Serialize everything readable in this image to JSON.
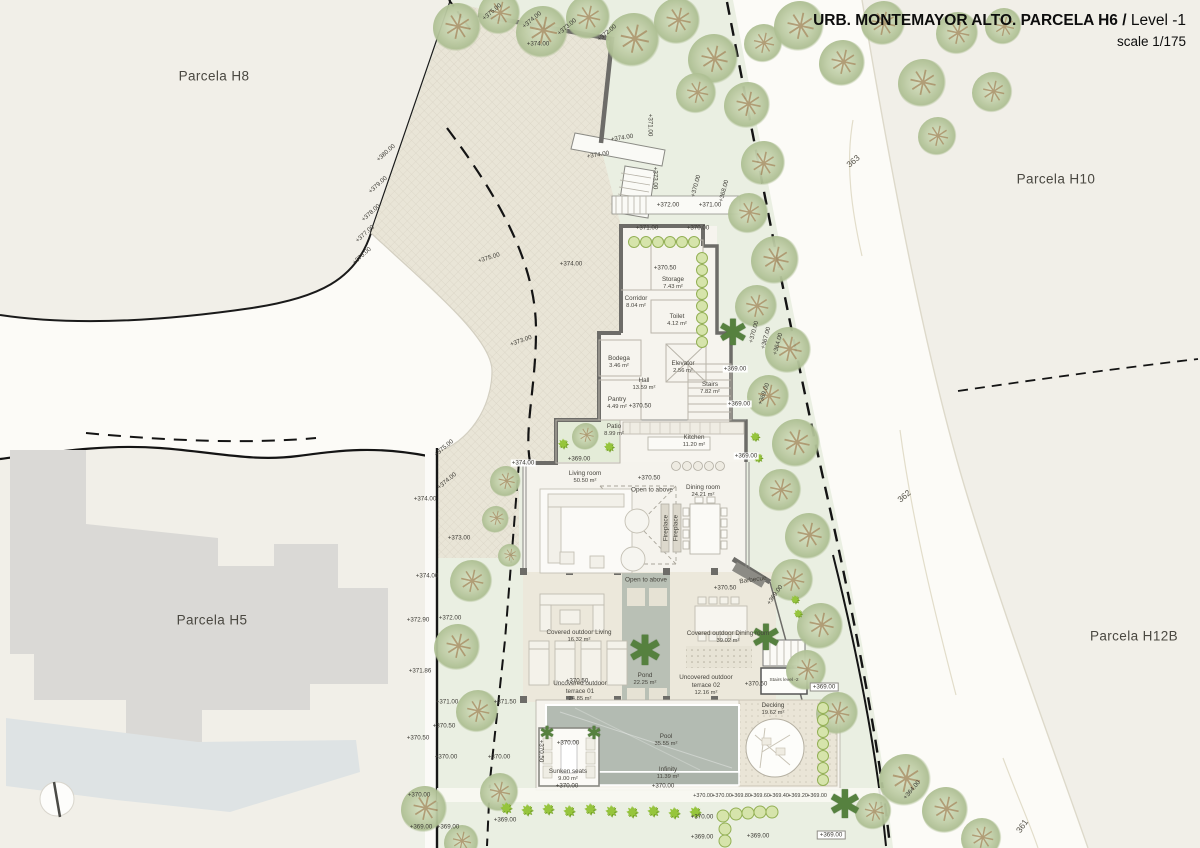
{
  "title": {
    "project": "URB. MONTEMAYOR ALTO. PARCELA H6 /",
    "level": " Level -1",
    "scale": "scale 1/175"
  },
  "parcel_labels": [
    {
      "t": "Parcela H8",
      "x": 214,
      "y": 76
    },
    {
      "t": "Parcela H10",
      "x": 1056,
      "y": 179
    },
    {
      "t": "Parcela H5",
      "x": 212,
      "y": 620
    },
    {
      "t": "Parcela H12B",
      "x": 1134,
      "y": 636
    }
  ],
  "contour_labels": [
    {
      "t": "363",
      "x": 853,
      "y": 161,
      "r": -40
    },
    {
      "t": "362",
      "x": 904,
      "y": 496,
      "r": -40
    },
    {
      "t": "361",
      "x": 1022,
      "y": 826,
      "r": -55
    }
  ],
  "rooms": [
    {
      "name": "Storage",
      "area": "7.43 m²",
      "x": 673,
      "y": 284
    },
    {
      "name": "Corridor",
      "area": "8.04 m²",
      "x": 636,
      "y": 303
    },
    {
      "name": "Toilet",
      "area": "4.12 m²",
      "x": 677,
      "y": 321
    },
    {
      "name": "Bodega",
      "area": "3.46 m²",
      "x": 619,
      "y": 363
    },
    {
      "name": "Elevator",
      "area": "2.56 m²",
      "x": 683,
      "y": 368
    },
    {
      "name": "Hall",
      "area": "13.59 m²",
      "x": 644,
      "y": 385
    },
    {
      "name": "Stairs",
      "area": "7.82 m²",
      "x": 710,
      "y": 389
    },
    {
      "name": "Pantry",
      "area": "4.49 m²",
      "x": 617,
      "y": 404
    },
    {
      "name": "Patio",
      "area": "8.99 m²",
      "x": 614,
      "y": 431
    },
    {
      "name": "Kitchen",
      "area": "11.20 m²",
      "x": 694,
      "y": 442
    },
    {
      "name": "Living room",
      "area": "50.50 m²",
      "x": 585,
      "y": 478
    },
    {
      "name": "Dining room",
      "area": "24.21 m²",
      "x": 703,
      "y": 492
    },
    {
      "name": "Covered outdoor Living",
      "area": "16.32 m²",
      "x": 579,
      "y": 637
    },
    {
      "name": "Covered outdoor Dining room",
      "area": "39.02 m²",
      "x": 728,
      "y": 638
    },
    {
      "name": "Pond",
      "area": "22.25 m²",
      "x": 645,
      "y": 680
    },
    {
      "name": "Uncovered outdoor",
      "name2": "terrace 01",
      "area": "24.85 m²",
      "x": 580,
      "y": 692
    },
    {
      "name": "Uncovered outdoor",
      "name2": "terrace 02",
      "area": "12.16 m²",
      "x": 706,
      "y": 686
    },
    {
      "name": "Stairs level -2",
      "area": "",
      "x": 784,
      "y": 681,
      "c": "sm"
    },
    {
      "name": "Decking",
      "area": "19.62 m²",
      "x": 773,
      "y": 710
    },
    {
      "name": "Pool",
      "area": "35.55 m²",
      "x": 666,
      "y": 741
    },
    {
      "name": "Infinity",
      "area": "11.39 m²",
      "x": 668,
      "y": 774
    },
    {
      "name": "Sunken seats",
      "area": "9.00 m²",
      "x": 568,
      "y": 776
    }
  ],
  "annotations": [
    {
      "t": "Open to above",
      "x": 652,
      "y": 490
    },
    {
      "t": "Open to above",
      "x": 646,
      "y": 580
    },
    {
      "t": "Barbecue",
      "x": 753,
      "y": 580,
      "r": -8
    },
    {
      "t": "Fireplace",
      "x": 666,
      "y": 528,
      "r": -90
    },
    {
      "t": "Fireplace",
      "x": 676,
      "y": 528,
      "r": -90
    }
  ],
  "elevations": [
    {
      "t": "+374.00",
      "x": 538,
      "y": 44
    },
    {
      "t": "+374.00",
      "x": 622,
      "y": 138,
      "r": -9
    },
    {
      "t": "+374.00",
      "x": 598,
      "y": 155,
      "r": -9
    },
    {
      "t": "+375.00",
      "x": 492,
      "y": 12,
      "r": -40
    },
    {
      "t": "+374.00",
      "x": 532,
      "y": 20,
      "r": -40
    },
    {
      "t": "+373.00",
      "x": 567,
      "y": 27,
      "r": -40
    },
    {
      "t": "+372.00",
      "x": 607,
      "y": 33,
      "r": -40
    },
    {
      "t": "+371.00",
      "x": 650,
      "y": 125,
      "r": 90
    },
    {
      "t": "+373.00",
      "x": 655,
      "y": 178,
      "r": 90
    },
    {
      "t": "+372.00",
      "x": 668,
      "y": 205
    },
    {
      "t": "+371.00",
      "x": 710,
      "y": 205
    },
    {
      "t": "+371.00",
      "x": 647,
      "y": 228
    },
    {
      "t": "+370.00",
      "x": 698,
      "y": 228
    },
    {
      "t": "+370.00",
      "x": 696,
      "y": 186,
      "r": -75
    },
    {
      "t": "+368.00",
      "x": 724,
      "y": 191,
      "r": -75
    },
    {
      "t": "+380.00",
      "x": 386,
      "y": 153,
      "r": -42
    },
    {
      "t": "+379.00",
      "x": 378,
      "y": 185,
      "r": -42
    },
    {
      "t": "+378.00",
      "x": 371,
      "y": 213,
      "r": -42
    },
    {
      "t": "+377.00",
      "x": 365,
      "y": 234,
      "r": -42
    },
    {
      "t": "+376.00",
      "x": 362,
      "y": 256,
      "r": -42
    },
    {
      "t": "+375.00",
      "x": 489,
      "y": 258,
      "r": -18
    },
    {
      "t": "+374.00",
      "x": 571,
      "y": 264
    },
    {
      "t": "+373.00",
      "x": 521,
      "y": 341,
      "r": -20
    },
    {
      "t": "+375.00",
      "x": 444,
      "y": 448,
      "r": -40
    },
    {
      "t": "+374.00",
      "x": 523,
      "y": 463,
      "c": "bg"
    },
    {
      "t": "+374.00",
      "x": 447,
      "y": 481,
      "r": -40
    },
    {
      "t": "+374.00",
      "x": 425,
      "y": 499
    },
    {
      "t": "+373.00",
      "x": 459,
      "y": 538
    },
    {
      "t": "+374.00",
      "x": 427,
      "y": 576
    },
    {
      "t": "+372.90",
      "x": 418,
      "y": 620
    },
    {
      "t": "+372.00",
      "x": 450,
      "y": 618
    },
    {
      "t": "+371.86",
      "x": 420,
      "y": 671
    },
    {
      "t": "+371.00",
      "x": 447,
      "y": 702
    },
    {
      "t": "+371.50",
      "x": 505,
      "y": 702
    },
    {
      "t": "+370.50",
      "x": 418,
      "y": 738
    },
    {
      "t": "+370.50",
      "x": 444,
      "y": 726
    },
    {
      "t": "+370.00",
      "x": 446,
      "y": 757
    },
    {
      "t": "+370.00",
      "x": 499,
      "y": 757
    },
    {
      "t": "+370.00",
      "x": 419,
      "y": 795
    },
    {
      "t": "+369.00",
      "x": 421,
      "y": 827
    },
    {
      "t": "+369.00",
      "x": 448,
      "y": 827
    },
    {
      "t": "+369.00",
      "x": 505,
      "y": 820
    },
    {
      "t": "+370.50",
      "x": 665,
      "y": 268
    },
    {
      "t": "+370.50",
      "x": 640,
      "y": 406
    },
    {
      "t": "+370.50",
      "x": 649,
      "y": 478
    },
    {
      "t": "+369.00",
      "x": 735,
      "y": 369,
      "c": "bg"
    },
    {
      "t": "+369.00",
      "x": 739,
      "y": 404,
      "c": "bg"
    },
    {
      "t": "+369.00",
      "x": 746,
      "y": 456,
      "c": "bg"
    },
    {
      "t": "+369.00",
      "x": 579,
      "y": 459
    },
    {
      "t": "+370.50",
      "x": 725,
      "y": 588
    },
    {
      "t": "+369.00",
      "x": 775,
      "y": 595,
      "r": -55
    },
    {
      "t": "+370.50",
      "x": 577,
      "y": 681
    },
    {
      "t": "+370.50",
      "x": 756,
      "y": 684
    },
    {
      "t": "+369.00",
      "x": 824,
      "y": 687,
      "c": "box"
    },
    {
      "t": "+370.00",
      "x": 568,
      "y": 743
    },
    {
      "t": "+370.00",
      "x": 567,
      "y": 786
    },
    {
      "t": "+370.50",
      "x": 541,
      "y": 751,
      "r": 90
    },
    {
      "t": "+370.00",
      "x": 663,
      "y": 786
    },
    {
      "t": "+370.00",
      "x": 703,
      "y": 796,
      "c": "seq"
    },
    {
      "t": "+370.00",
      "x": 722,
      "y": 796,
      "c": "seq"
    },
    {
      "t": "+369.80",
      "x": 741,
      "y": 796,
      "c": "seq"
    },
    {
      "t": "+369.60",
      "x": 760,
      "y": 796,
      "c": "seq"
    },
    {
      "t": "+369.40",
      "x": 779,
      "y": 796,
      "c": "seq"
    },
    {
      "t": "+369.20",
      "x": 798,
      "y": 796,
      "c": "seq"
    },
    {
      "t": "+369.00",
      "x": 817,
      "y": 796,
      "c": "seq"
    },
    {
      "t": "+370.00",
      "x": 702,
      "y": 817
    },
    {
      "t": "+369.00",
      "x": 702,
      "y": 837
    },
    {
      "t": "+369.00",
      "x": 758,
      "y": 836
    },
    {
      "t": "+369.00",
      "x": 831,
      "y": 835,
      "c": "box"
    },
    {
      "t": "+370.00",
      "x": 754,
      "y": 332,
      "r": -75
    },
    {
      "t": "+367.00",
      "x": 766,
      "y": 338,
      "r": -75
    },
    {
      "t": "+364.00",
      "x": 778,
      "y": 344,
      "r": -75
    },
    {
      "t": "+369.00",
      "x": 764,
      "y": 394,
      "r": -70
    },
    {
      "t": "+364.00",
      "x": 912,
      "y": 790,
      "r": -50
    }
  ],
  "vegetation": [
    {
      "t": "tree",
      "x": 458,
      "y": 28,
      "s": 50
    },
    {
      "t": "tree",
      "x": 500,
      "y": 14,
      "s": 44
    },
    {
      "t": "tree",
      "x": 543,
      "y": 33,
      "s": 54
    },
    {
      "t": "tree",
      "x": 589,
      "y": 18,
      "s": 46
    },
    {
      "t": "tree",
      "x": 634,
      "y": 41,
      "s": 56
    },
    {
      "t": "tree",
      "x": 678,
      "y": 22,
      "s": 48
    },
    {
      "t": "tree",
      "x": 714,
      "y": 60,
      "s": 52
    },
    {
      "t": "tree",
      "x": 748,
      "y": 106,
      "s": 48
    },
    {
      "t": "tree",
      "x": 697,
      "y": 94,
      "s": 42
    },
    {
      "t": "tree",
      "x": 764,
      "y": 44,
      "s": 40
    },
    {
      "t": "tree",
      "x": 800,
      "y": 27,
      "s": 52
    },
    {
      "t": "tree",
      "x": 843,
      "y": 64,
      "s": 48
    },
    {
      "t": "tree",
      "x": 884,
      "y": 24,
      "s": 46
    },
    {
      "t": "tree",
      "x": 923,
      "y": 84,
      "s": 50
    },
    {
      "t": "tree",
      "x": 958,
      "y": 34,
      "s": 44
    },
    {
      "t": "tree",
      "x": 993,
      "y": 93,
      "s": 42
    },
    {
      "t": "tree",
      "x": 1004,
      "y": 27,
      "s": 38
    },
    {
      "t": "tree",
      "x": 938,
      "y": 137,
      "s": 40
    },
    {
      "t": "tree",
      "x": 764,
      "y": 164,
      "s": 46
    },
    {
      "t": "tree",
      "x": 749,
      "y": 214,
      "s": 42
    },
    {
      "t": "tree",
      "x": 776,
      "y": 261,
      "s": 50
    },
    {
      "t": "tree",
      "x": 757,
      "y": 307,
      "s": 44
    },
    {
      "t": "tree",
      "x": 789,
      "y": 351,
      "s": 48
    },
    {
      "t": "tree",
      "x": 769,
      "y": 397,
      "s": 44
    },
    {
      "t": "tree",
      "x": 797,
      "y": 444,
      "s": 50
    },
    {
      "t": "tree",
      "x": 781,
      "y": 491,
      "s": 44
    },
    {
      "t": "tree",
      "x": 809,
      "y": 537,
      "s": 48
    },
    {
      "t": "tree",
      "x": 793,
      "y": 581,
      "s": 44
    },
    {
      "t": "tree",
      "x": 821,
      "y": 627,
      "s": 48
    },
    {
      "t": "tree",
      "x": 807,
      "y": 671,
      "s": 42
    },
    {
      "t": "tree",
      "x": 838,
      "y": 714,
      "s": 44
    },
    {
      "t": "tree",
      "x": 906,
      "y": 781,
      "s": 54
    },
    {
      "t": "tree",
      "x": 946,
      "y": 811,
      "s": 48
    },
    {
      "t": "tree",
      "x": 982,
      "y": 839,
      "s": 42
    },
    {
      "t": "tree",
      "x": 874,
      "y": 812,
      "s": 38
    },
    {
      "t": "tree",
      "x": 472,
      "y": 582,
      "s": 44
    },
    {
      "t": "tree",
      "x": 458,
      "y": 648,
      "s": 48
    },
    {
      "t": "tree",
      "x": 478,
      "y": 712,
      "s": 44
    },
    {
      "t": "tree",
      "x": 425,
      "y": 810,
      "s": 48
    },
    {
      "t": "tree",
      "x": 500,
      "y": 793,
      "s": 40
    },
    {
      "t": "tree",
      "x": 462,
      "y": 843,
      "s": 36
    },
    {
      "t": "tree",
      "x": 506,
      "y": 482,
      "s": 32
    },
    {
      "t": "tree",
      "x": 496,
      "y": 520,
      "s": 28
    },
    {
      "t": "tree",
      "x": 510,
      "y": 556,
      "s": 24
    },
    {
      "t": "tree",
      "x": 586,
      "y": 437,
      "s": 28
    },
    {
      "t": "palm",
      "x": 733,
      "y": 333,
      "s": 40
    },
    {
      "t": "palm",
      "x": 645,
      "y": 652,
      "s": 46
    },
    {
      "t": "palm",
      "x": 766,
      "y": 638,
      "s": 40
    },
    {
      "t": "palm",
      "x": 845,
      "y": 806,
      "s": 44
    },
    {
      "t": "palm",
      "x": 547,
      "y": 733,
      "s": 20
    },
    {
      "t": "palm",
      "x": 594,
      "y": 733,
      "s": 20
    },
    {
      "t": "bush",
      "x": 563,
      "y": 444,
      "s": 15
    },
    {
      "t": "bush",
      "x": 609,
      "y": 447,
      "s": 15
    },
    {
      "t": "bush",
      "x": 755,
      "y": 437,
      "s": 14
    },
    {
      "t": "bush",
      "x": 758,
      "y": 458,
      "s": 14
    },
    {
      "t": "bush",
      "x": 795,
      "y": 600,
      "s": 13
    },
    {
      "t": "bush",
      "x": 798,
      "y": 614,
      "s": 13
    },
    {
      "t": "bush",
      "x": 506,
      "y": 809,
      "s": 17
    },
    {
      "t": "bush",
      "x": 527,
      "y": 811,
      "s": 17
    },
    {
      "t": "bush",
      "x": 548,
      "y": 810,
      "s": 17
    },
    {
      "t": "bush",
      "x": 569,
      "y": 812,
      "s": 17
    },
    {
      "t": "bush",
      "x": 590,
      "y": 810,
      "s": 17
    },
    {
      "t": "bush",
      "x": 611,
      "y": 812,
      "s": 17
    },
    {
      "t": "bush",
      "x": 632,
      "y": 813,
      "s": 17
    },
    {
      "t": "bush",
      "x": 653,
      "y": 812,
      "s": 17
    },
    {
      "t": "bush",
      "x": 674,
      "y": 814,
      "s": 17
    },
    {
      "t": "bush",
      "x": 695,
      "y": 813,
      "s": 17
    },
    {
      "t": "cb",
      "x": 634,
      "y": 242,
      "s": 12
    },
    {
      "t": "cb",
      "x": 646,
      "y": 242,
      "s": 12
    },
    {
      "t": "cb",
      "x": 658,
      "y": 242,
      "s": 12
    },
    {
      "t": "cb",
      "x": 670,
      "y": 242,
      "s": 12
    },
    {
      "t": "cb",
      "x": 682,
      "y": 242,
      "s": 12
    },
    {
      "t": "cb",
      "x": 694,
      "y": 242,
      "s": 12
    },
    {
      "t": "cb",
      "x": 702,
      "y": 258,
      "s": 12
    },
    {
      "t": "cb",
      "x": 702,
      "y": 270,
      "s": 12
    },
    {
      "t": "cb",
      "x": 702,
      "y": 282,
      "s": 12
    },
    {
      "t": "cb",
      "x": 702,
      "y": 294,
      "s": 12
    },
    {
      "t": "cb",
      "x": 702,
      "y": 306,
      "s": 12
    },
    {
      "t": "cb",
      "x": 702,
      "y": 318,
      "s": 12
    },
    {
      "t": "cb",
      "x": 702,
      "y": 330,
      "s": 12
    },
    {
      "t": "cb",
      "x": 702,
      "y": 342,
      "s": 12
    },
    {
      "t": "cb",
      "x": 723,
      "y": 816,
      "s": 13
    },
    {
      "t": "cb",
      "x": 736,
      "y": 814,
      "s": 13
    },
    {
      "t": "cb",
      "x": 748,
      "y": 813,
      "s": 13
    },
    {
      "t": "cb",
      "x": 760,
      "y": 812,
      "s": 13
    },
    {
      "t": "cb",
      "x": 772,
      "y": 812,
      "s": 13
    },
    {
      "t": "cb",
      "x": 725,
      "y": 829,
      "s": 13
    },
    {
      "t": "cb",
      "x": 725,
      "y": 841,
      "s": 13
    },
    {
      "t": "cb",
      "x": 823,
      "y": 708,
      "s": 12
    },
    {
      "t": "cb",
      "x": 823,
      "y": 720,
      "s": 12
    },
    {
      "t": "cb",
      "x": 823,
      "y": 732,
      "s": 12
    },
    {
      "t": "cb",
      "x": 823,
      "y": 744,
      "s": 12
    },
    {
      "t": "cb",
      "x": 823,
      "y": 756,
      "s": 12
    },
    {
      "t": "cb",
      "x": 823,
      "y": 768,
      "s": 12
    },
    {
      "t": "cb",
      "x": 823,
      "y": 780,
      "s": 12
    }
  ]
}
